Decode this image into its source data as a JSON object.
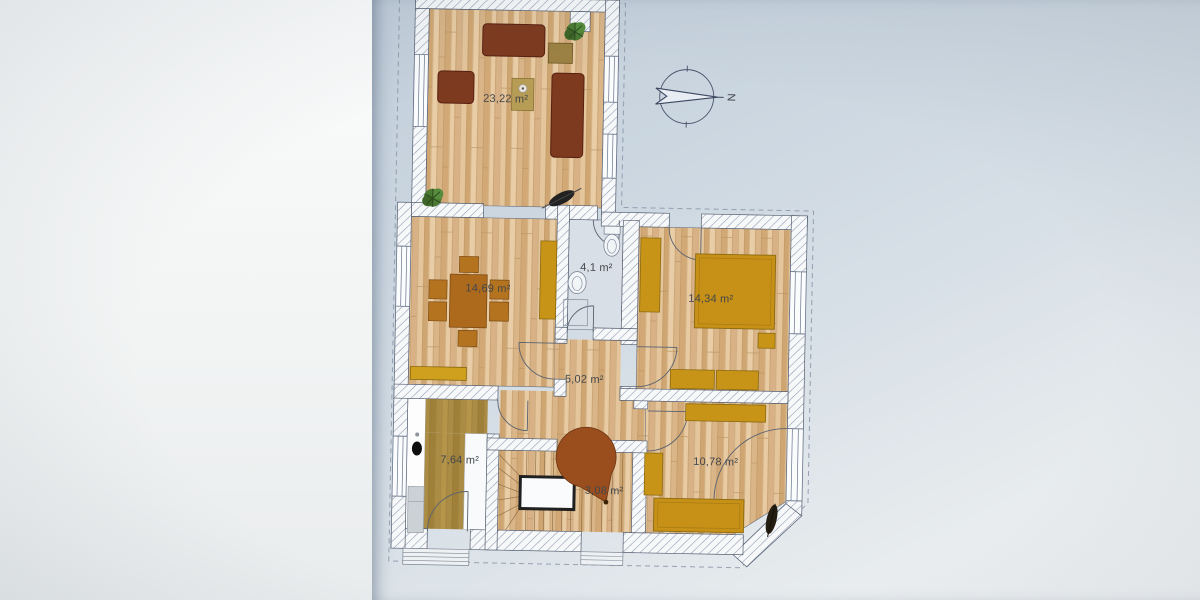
{
  "document": {
    "kind": "apartment-floor-plan-photo"
  },
  "compass": {
    "label": "N"
  },
  "rooms": {
    "living": {
      "area": "23,22 m²"
    },
    "dining": {
      "area": "14,69 m²"
    },
    "bath": {
      "area": "4,1 m²"
    },
    "bedroom_large": {
      "area": "14,34 m²"
    },
    "hall": {
      "area": "5,02 m²"
    },
    "kitchen": {
      "area": "7,64 m²"
    },
    "stairs": {
      "area": "3,08 m²"
    },
    "bedroom_small": {
      "area": "10,78 m²"
    }
  },
  "colors": {
    "paper": "#cbd6e0",
    "backdrop": "#f2f4f4",
    "wood_floor": "#dfc095",
    "kitchen_floor": "#ab8c45",
    "bath_floor": "#d8dfe7",
    "sofa_brown": "#7d3a1f",
    "furniture_yellow": "#c79418",
    "dining_table": "#ad6a1d",
    "stair_circle": "#9a4e1e",
    "wall_line": "#535d6e"
  }
}
